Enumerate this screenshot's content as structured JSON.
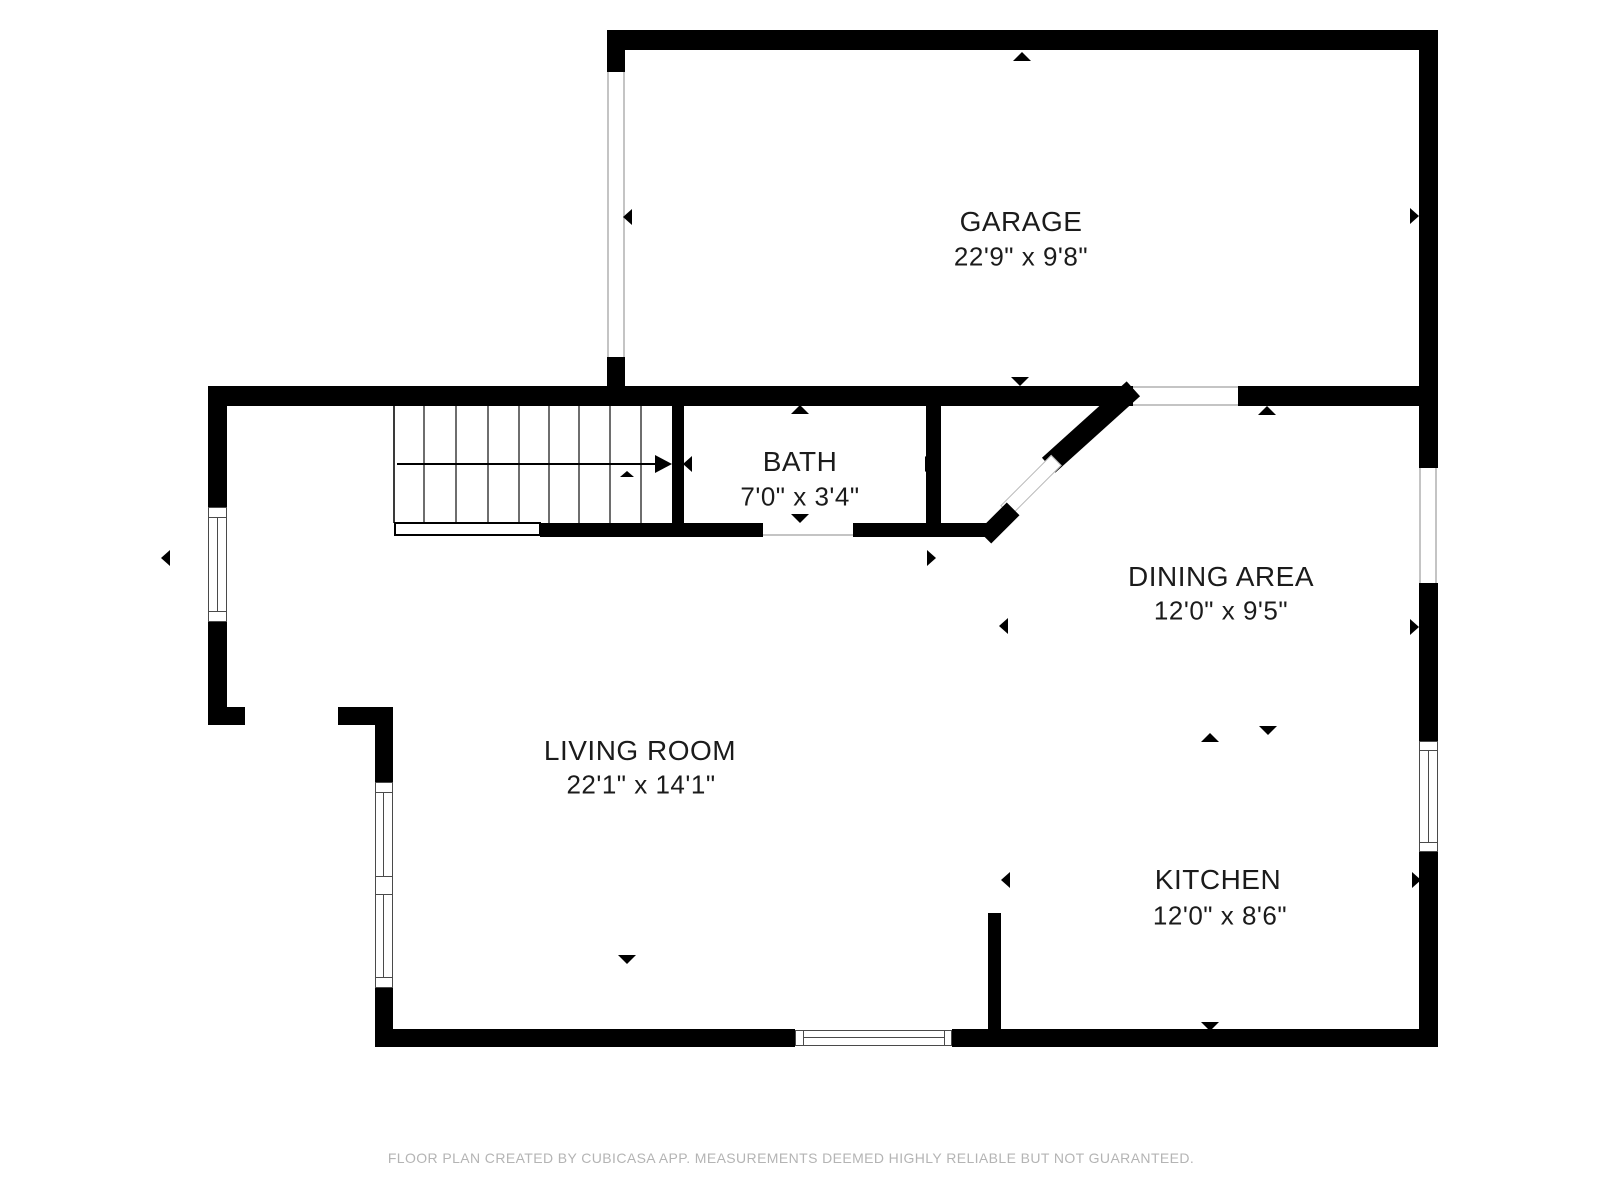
{
  "rooms": {
    "garage": {
      "name": "GARAGE",
      "dims": "22'9\" x 9'8\""
    },
    "bath": {
      "name": "BATH",
      "dims": "7'0\" x 3'4\""
    },
    "dining": {
      "name": "DINING AREA",
      "dims": "12'0\" x 9'5\""
    },
    "living": {
      "name": "LIVING ROOM",
      "dims": "22'1\" x 14'1\""
    },
    "kitchen": {
      "name": "KITCHEN",
      "dims": "12'0\" x 8'6\""
    }
  },
  "footer": {
    "disclaimer": "FLOOR PLAN CREATED BY CUBICASA APP. MEASUREMENTS DEEMED HIGHLY RELIABLE BUT NOT GUARANTEED."
  },
  "colors": {
    "wall": "#000000",
    "text": "#1b1b1b",
    "footer_text": "#b4b4b4",
    "window_line": "#4a4a4a",
    "opening_line": "#c4c4c4",
    "background": "#ffffff"
  }
}
